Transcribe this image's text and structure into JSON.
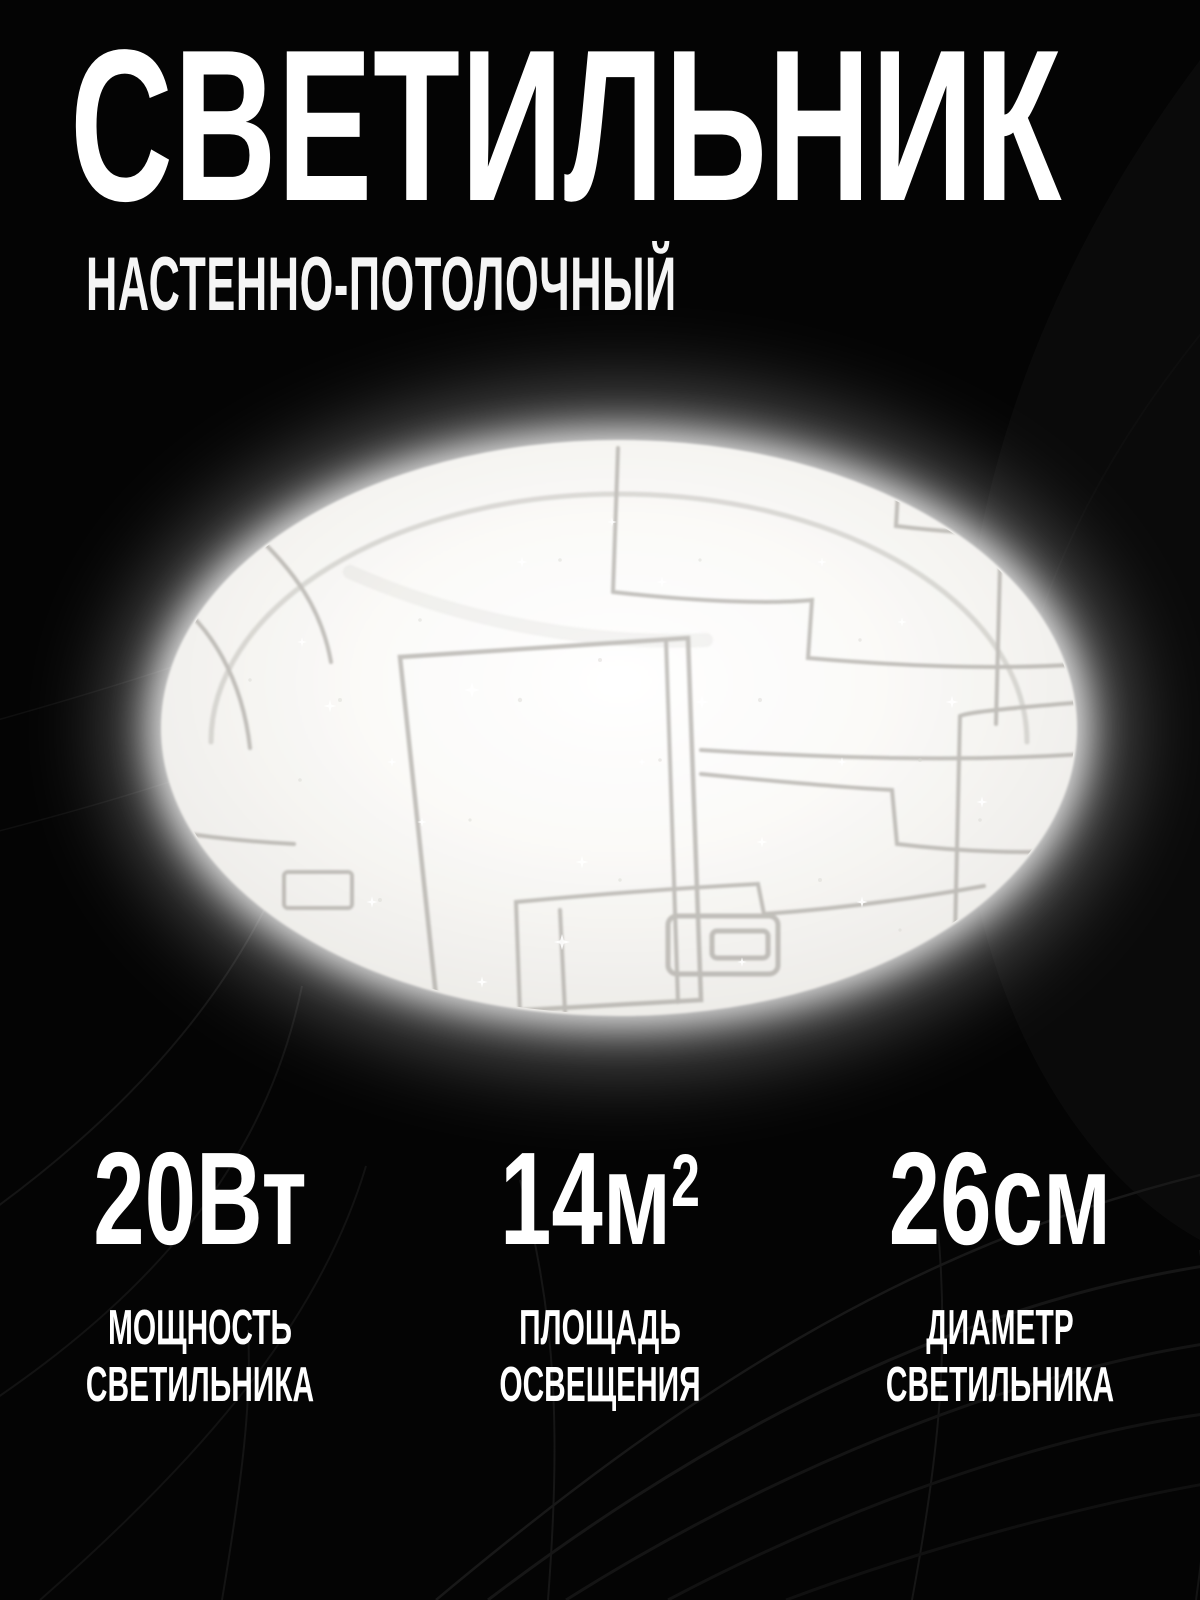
{
  "colors": {
    "background": "#040404",
    "text": "#ffffff",
    "lamp_glow": "#ffffff",
    "lamp_pattern_line": "#a19e98",
    "swirl_line": "#161616"
  },
  "header": {
    "title": "СВЕТИЛЬНИК",
    "subtitle": "НАСТЕННО-ПОТОЛОЧНЫЙ"
  },
  "lamp": {
    "image_name": "ceiling-lamp-glowing-photo"
  },
  "specs": [
    {
      "value": "20",
      "unit": "Вт",
      "sup": "",
      "label_line1": "МОЩНОСТЬ",
      "label_line2": "СВЕТИЛЬНИКА"
    },
    {
      "value": "14",
      "unit": "м",
      "sup": "2",
      "label_line1": "ПЛОЩАДЬ",
      "label_line2": "ОСВЕЩЕНИЯ"
    },
    {
      "value": "26",
      "unit": "см",
      "sup": "",
      "label_line1": "ДИАМЕТР",
      "label_line2": "СВЕТИЛЬНИКА"
    }
  ]
}
